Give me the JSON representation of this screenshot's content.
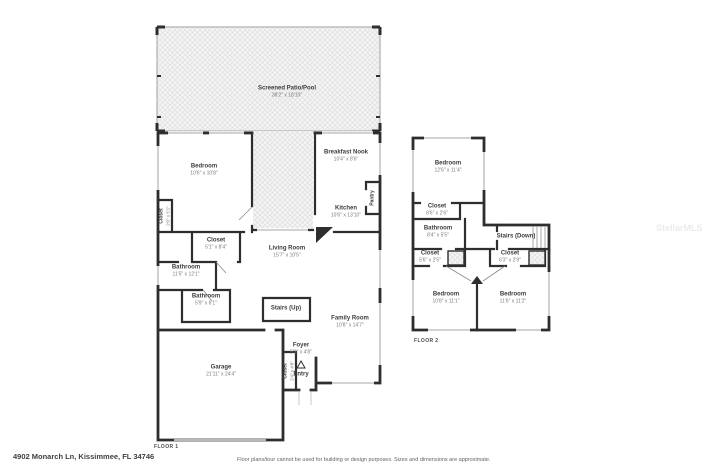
{
  "floor1": {
    "label": "FLOOR 1",
    "rooms": {
      "patio": {
        "name": "Screened Patio/Pool",
        "dims": "38'2\" x 18'10\""
      },
      "bedroom": {
        "name": "Bedroom",
        "dims": "10'6\" x 10'8\""
      },
      "closet_hall": {
        "name": "Closet",
        "dims": "2'0\" x 5'1\""
      },
      "closet_main": {
        "name": "Closet",
        "dims": "5'1\" x 8'4\""
      },
      "bathroom_main": {
        "name": "Bathroom",
        "dims": "11'5\" x 12'1\""
      },
      "bathroom_half": {
        "name": "Bathroom",
        "dims": "5'9\" x 6'1\""
      },
      "living": {
        "name": "Living Room",
        "dims": "15'7\" x 10'5\""
      },
      "breakfast": {
        "name": "Breakfast Nook",
        "dims": "10'4\" x 8'6\""
      },
      "kitchen": {
        "name": "Kitchen",
        "dims": "10'6\" x 13'10\""
      },
      "pantry": {
        "name": "Pantry"
      },
      "stairs": {
        "name": "Stairs (Up)"
      },
      "family": {
        "name": "Family Room",
        "dims": "10'8\" x 14'7\""
      },
      "foyer": {
        "name": "Foyer",
        "dims": "5'3\" x 4'8\""
      },
      "entry": {
        "name": "Entry"
      },
      "closet_entry": {
        "name": "Closet",
        "dims": "2'4\" x 4'8\""
      },
      "garage": {
        "name": "Garage",
        "dims": "21'11\" x 24'4\""
      }
    }
  },
  "floor2": {
    "label": "FLOOR 2",
    "rooms": {
      "bedroom_primary": {
        "name": "Bedroom",
        "dims": "12'6\" x 11'4\""
      },
      "closet_top": {
        "name": "Closet",
        "dims": "8'6\" x 2'6\""
      },
      "bathroom": {
        "name": "Bathroom",
        "dims": "8'4\" x 5'5\""
      },
      "stairs": {
        "name": "Stairs (Down)"
      },
      "closet_left": {
        "name": "Closet",
        "dims": "5'6\" x 2'5\""
      },
      "closet_right": {
        "name": "Closet",
        "dims": "6'3\" x 2'9\""
      },
      "bedroom_left": {
        "name": "Bedroom",
        "dims": "10'8\" x 11'1\""
      },
      "bedroom_right": {
        "name": "Bedroom",
        "dims": "11'6\" x 11'2\""
      }
    }
  },
  "footer": {
    "address": "4902 Monarch Ln, Kissimmee, FL 34746",
    "disclaimer": "Floor plans/tour cannot be used for building or design purposes. Sizes and dimensions are approximate."
  },
  "watermark": "StellarMLS",
  "colors": {
    "wall": "#2e2e2e",
    "window": "#b8b8b8",
    "hatch_line": "#dedede",
    "hatch_bg": "#f4f4f4"
  }
}
